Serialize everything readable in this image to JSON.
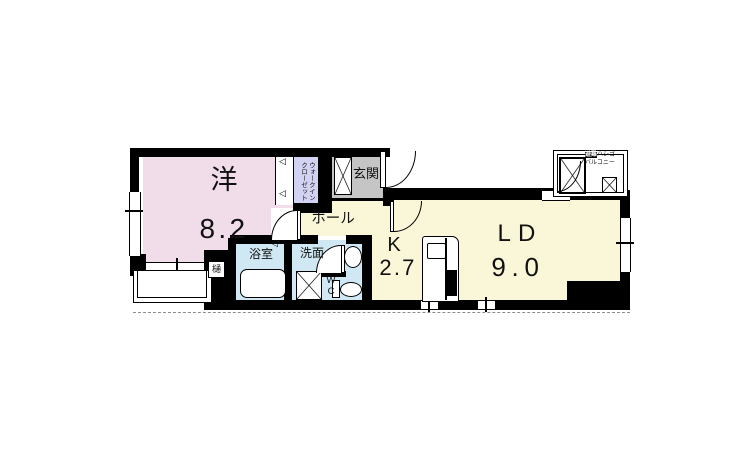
{
  "colors": {
    "room_pink": "#f1dcea",
    "wic_lavender": "#d2d2f2",
    "floor_cream": "#faf6d8",
    "wet_blue": "#cfe8f3",
    "genkan_gray": "#c5c5c5",
    "wall": "#000000",
    "line_gray": "#8c8c8c"
  },
  "rooms": {
    "western": {
      "label": "洋",
      "size": "8.2"
    },
    "wic": {
      "lines": [
        "ウォークイン",
        "クローゼット"
      ]
    },
    "genkan": {
      "label": "玄関"
    },
    "hall": {
      "label": "ホール"
    },
    "bath": {
      "label": "浴室"
    },
    "washroom": {
      "label": "洗面"
    },
    "wc": {
      "chars": [
        "W",
        "C"
      ]
    },
    "kitchen": {
      "label": "K",
      "size": "2.7"
    },
    "living_dining": {
      "label": "LD",
      "size": "9.0"
    },
    "balcony": {
      "ladder_em": "避難",
      "ladder_rest": "ハシゴ",
      "name": "バルコニー"
    }
  },
  "misc": {
    "gutter_label": "樋",
    "door_triangle": "◁"
  }
}
